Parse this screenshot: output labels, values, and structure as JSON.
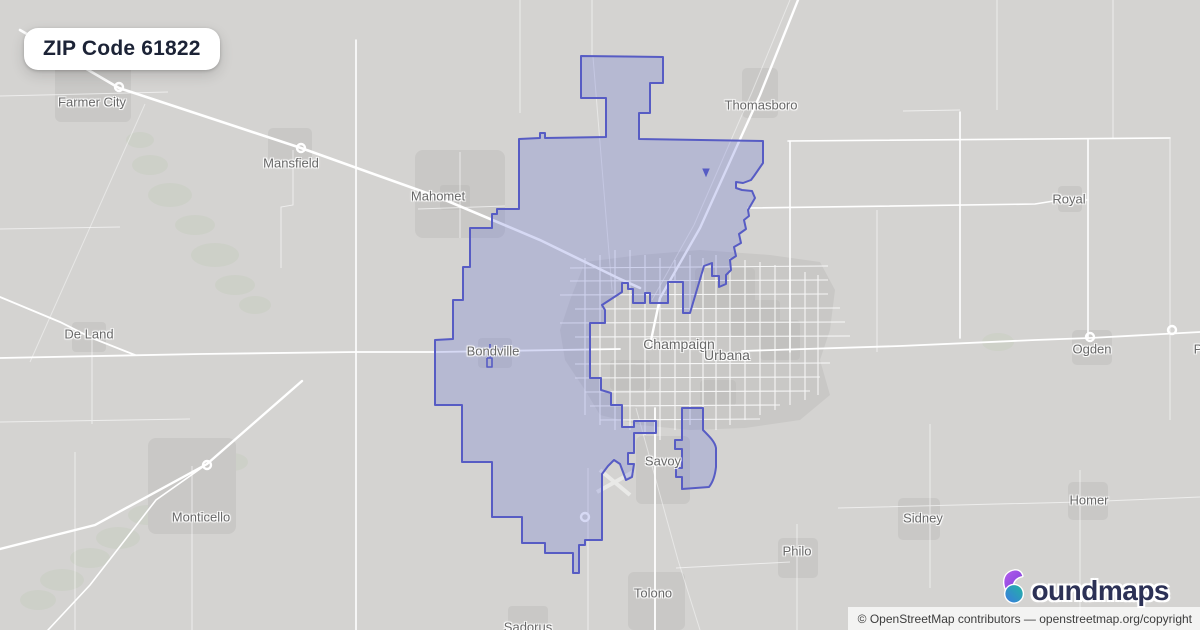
{
  "badge": {
    "title": "ZIP Code 61822"
  },
  "map": {
    "labels": [
      {
        "text": "Farmer City",
        "x": 92,
        "y": 102
      },
      {
        "text": "Mansfield",
        "x": 291,
        "y": 163
      },
      {
        "text": "Mahomet",
        "x": 438,
        "y": 196
      },
      {
        "text": "Thomasboro",
        "x": 761,
        "y": 105
      },
      {
        "text": "Royal",
        "x": 1069,
        "y": 199
      },
      {
        "text": "De Land",
        "x": 89,
        "y": 334
      },
      {
        "text": "Bondville",
        "x": 493,
        "y": 351
      },
      {
        "text": "Champaign",
        "x": 679,
        "y": 344
      },
      {
        "text": "Urbana",
        "x": 727,
        "y": 355
      },
      {
        "text": "Ogden",
        "x": 1092,
        "y": 349
      },
      {
        "text": "Monticello",
        "x": 201,
        "y": 517
      },
      {
        "text": "Savoy",
        "x": 663,
        "y": 461
      },
      {
        "text": "Sidney",
        "x": 923,
        "y": 518
      },
      {
        "text": "Homer",
        "x": 1089,
        "y": 500
      },
      {
        "text": "Philo",
        "x": 797,
        "y": 551
      },
      {
        "text": "Tolono",
        "x": 653,
        "y": 593
      },
      {
        "text": "Sadorus",
        "x": 528,
        "y": 627
      },
      {
        "text": "P",
        "x": 1198,
        "y": 349
      }
    ],
    "boundary": {
      "zip": "61822",
      "fill": "#6971d6",
      "fill_opacity": "0.27",
      "stroke": "#575cc4",
      "main_path": "M581,56 L581,98 L606,98 L606,137 L545,138 L545,133 L540,133 L540,138 L519,139 L519,209 L497,209 L497,214 L492,214 L492,228 L470,228 L470,267 L463,267 L463,300 L453,300 L453,339 L435,340 L435,405 L462,405 L462,462 L492,462 L492,517 L522,517 L522,543 L545,543 L545,553 L573,553 L573,573 L579,573 L579,545 L585,545 L585,540 L602,540 L602,474 L608,466 L614,460 L620,464 L626,480 L632,477 L634,464 L628,464 L628,453 L634,453 L634,433 L656,433 L656,421 L634,421 L634,427 L622,427 L622,405 L611,405 L611,393 L601,390 L601,378 L590,378 L590,323 L605,323 L605,310 L602,305 L622,292 L622,283 L628,283 L628,289 L633,289 L633,303 L645,303 L645,293 L650,293 L650,303 L668,303 L668,282 L683,282 L683,313 L690,313 L704,266 L712,263 L712,276 L719,276 L719,287 L726,284 L726,275 L731,270 L730,260 L736,256 L734,247 L741,243 L739,234 L746,229 L744,220 L749,216 L748,210 L755,198 L752,191 L742,190 L736,188 L736,182 L743,183 L751,180 L754,176 L763,163 L763,141 L639,139 L639,113 L650,113 L650,83 L663,83 L663,57 Z",
      "east_blob_path": "M682,408 L703,408 L703,430 C710,437 715,442 716,448 L716,467 C715,476 713,482 709,487 L682,489 L682,477 L676,477 L676,468 L682,468 L682,449 L675,449 L675,440 L682,440 Z",
      "sliver_path": "M483,351 L516,349 M490,344 L490,358 M487,358 L492,358 L492,367 L487,367 L487,358",
      "dot_path": "M703,169 L709,169 L706,176 Z"
    },
    "colors": {
      "background": "#d4d3d1",
      "urban": "#c9c8c6",
      "urban_dark": "#c2c1bf",
      "road": "#ffffff",
      "vegetation": "#ccd0c7",
      "label": "#686868"
    }
  },
  "logo": {
    "brand_full": "boundmaps",
    "brand_rest": "oundmaps",
    "icon": "boundmaps-b-pin-icon",
    "navy": "#2c3156",
    "purple": "#9a4fe0",
    "blue": "#3a7be0",
    "teal": "#22b3a4"
  },
  "attribution": {
    "text": "© OpenStreetMap contributors — openstreetmap.org/copyright"
  }
}
